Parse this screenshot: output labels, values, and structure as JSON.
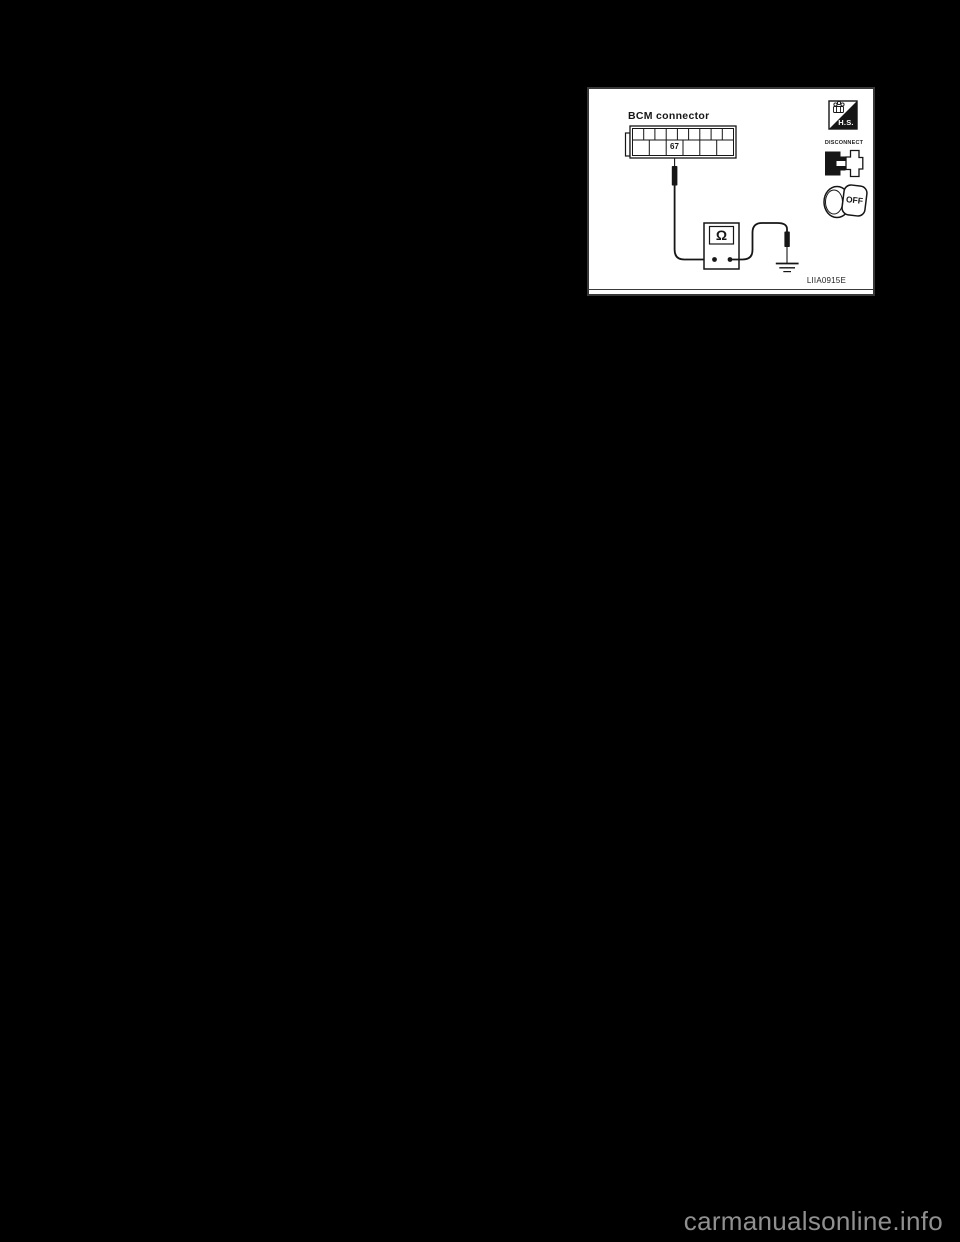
{
  "page": {
    "background_color": "#000000",
    "watermark_text": "carmanualsonline.info"
  },
  "figure": {
    "code": "LIIA0915E",
    "title": "BCM connector",
    "connector": {
      "pin_label": "67",
      "top_row_cells": 9,
      "bottom_row_cells": 6
    },
    "meter": {
      "display_symbol": "Ω"
    },
    "badges": {
      "hs_label": "H.S.",
      "disconnect_label": "DISCONNECT",
      "ignition_label": "OFF"
    },
    "colors": {
      "paper": "#ffffff",
      "ink": "#161616",
      "frame": "#3a3a3a",
      "watermark": "#909090"
    }
  }
}
